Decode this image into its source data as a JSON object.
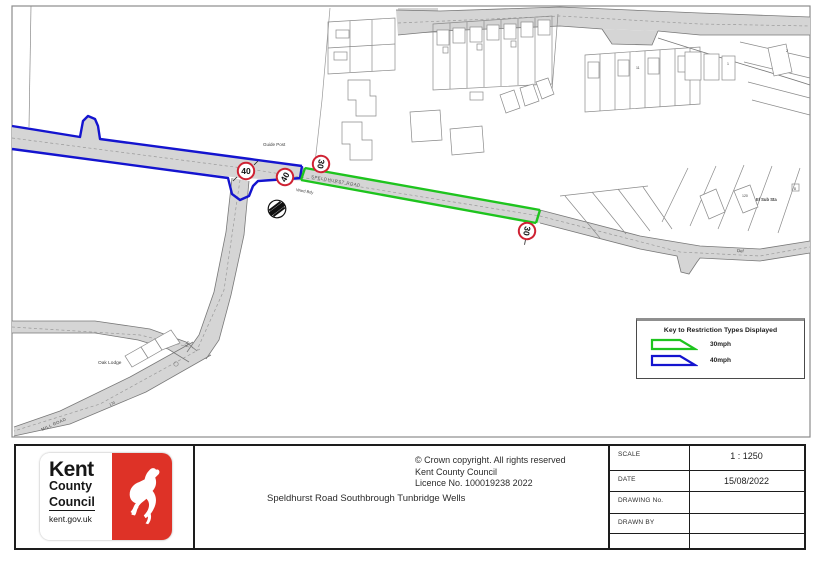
{
  "map": {
    "labels": {
      "guide_post": "Guide Post",
      "road_name": "SPELDHURST ROAD",
      "ward_bdy": "Ward Bdy",
      "oak_lodge": "Oak Lodge",
      "el_sub_sta": "El Sub Sta",
      "def": "Def",
      "mill_road": "MILL ROAD",
      "num_170a": "170",
      "num_170b": "170",
      "num_120": "120",
      "num_11": "11",
      "num_1": "1",
      "num_2": "2",
      "num_8": "8"
    },
    "signs": {
      "speed_40": "40",
      "speed_30": "30"
    },
    "colors": {
      "restriction_30mph": "#1ec41e",
      "restriction_40mph": "#1414cf",
      "roundel_ring": "#cf2233",
      "road_fill": "#d5d5d5"
    }
  },
  "legend": {
    "title": "Key to Restriction Types Displayed",
    "items": [
      {
        "label": "30mph",
        "color": "#1ec41e"
      },
      {
        "label": "40mph",
        "color": "#1414cf"
      }
    ]
  },
  "title_block": {
    "logo": {
      "line1": "Kent",
      "line2": "County",
      "line3": "Council",
      "line4": "kent.gov.uk"
    },
    "copyright": [
      "© Crown copyright. All rights reserved",
      "Kent County Council",
      "Licence No. 100019238 2022"
    ],
    "drawing_title": "Speldhurst Road Southbrough Tunbridge Wells",
    "table": [
      {
        "label": "SCALE",
        "value": "1 : 1250"
      },
      {
        "label": "DATE",
        "value": "15/08/2022"
      },
      {
        "label": "DRAWING No.",
        "value": ""
      },
      {
        "label": "DRAWN BY",
        "value": ""
      }
    ]
  }
}
